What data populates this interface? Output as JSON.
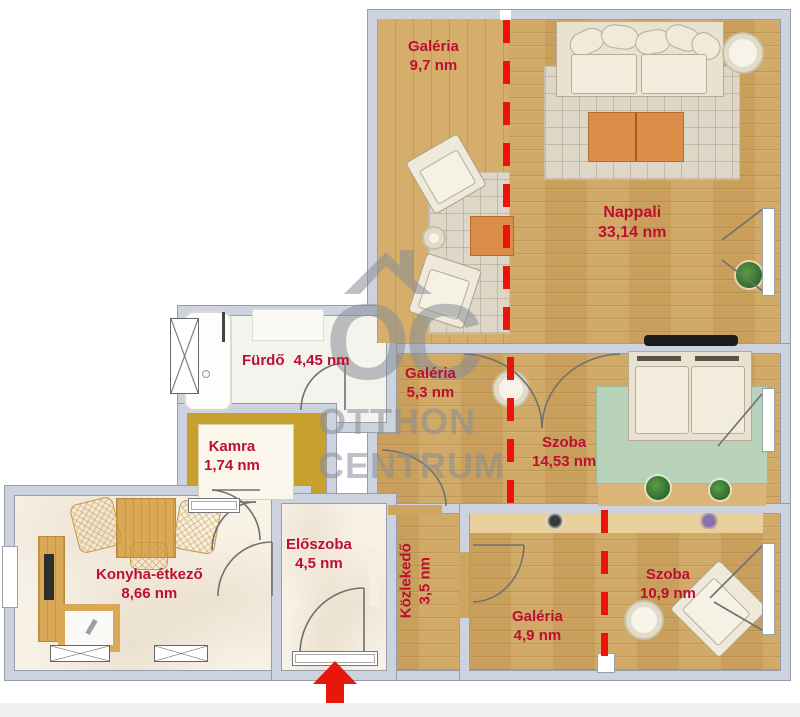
{
  "rooms": {
    "galeria_top": {
      "name": "Galéria",
      "area": "9,7 nm"
    },
    "nappali": {
      "name": "Nappali",
      "area": "33,14 nm"
    },
    "furdo": {
      "name": "Fürdő",
      "area": "4,45 nm"
    },
    "galeria_mid": {
      "name": "Galéria",
      "area": "5,3 nm"
    },
    "szoba_mid": {
      "name": "Szoba",
      "area": "14,53 nm"
    },
    "kamra": {
      "name": "Kamra",
      "area": "1,74 nm"
    },
    "konyha": {
      "name": "Konyha-étkező",
      "area": "8,66 nm"
    },
    "eloszoba": {
      "name": "Előszoba",
      "area": "4,5 nm"
    },
    "kozlekedo": {
      "name": "Közlekedő",
      "area": "3,5 nm"
    },
    "galeria_bottom": {
      "name": "Galéria",
      "area": "4,9 nm"
    },
    "szoba_bottom": {
      "name": "Szoba",
      "area": "10,9 nm"
    }
  },
  "watermark": {
    "logo": "OC",
    "line1": "OTTHON",
    "line2": "CENTRUM"
  },
  "icons": {
    "entrance_arrow": "arrow-up",
    "watermark_logo": "house-roof"
  },
  "colors": {
    "label_red": "#bc0f32",
    "dashed_line_red": "#ec130b",
    "arrow_red": "#e8170d",
    "wall_gray": "#ccd3df",
    "wood_floor": "#cfa55f",
    "wood_floor_light": "#d6ae6b",
    "kamra_mustard": "#c7a02e",
    "rug_green": "#b8d2b9",
    "table_orange": "#dc8d47",
    "watermark_gray": "#8a8f99"
  }
}
